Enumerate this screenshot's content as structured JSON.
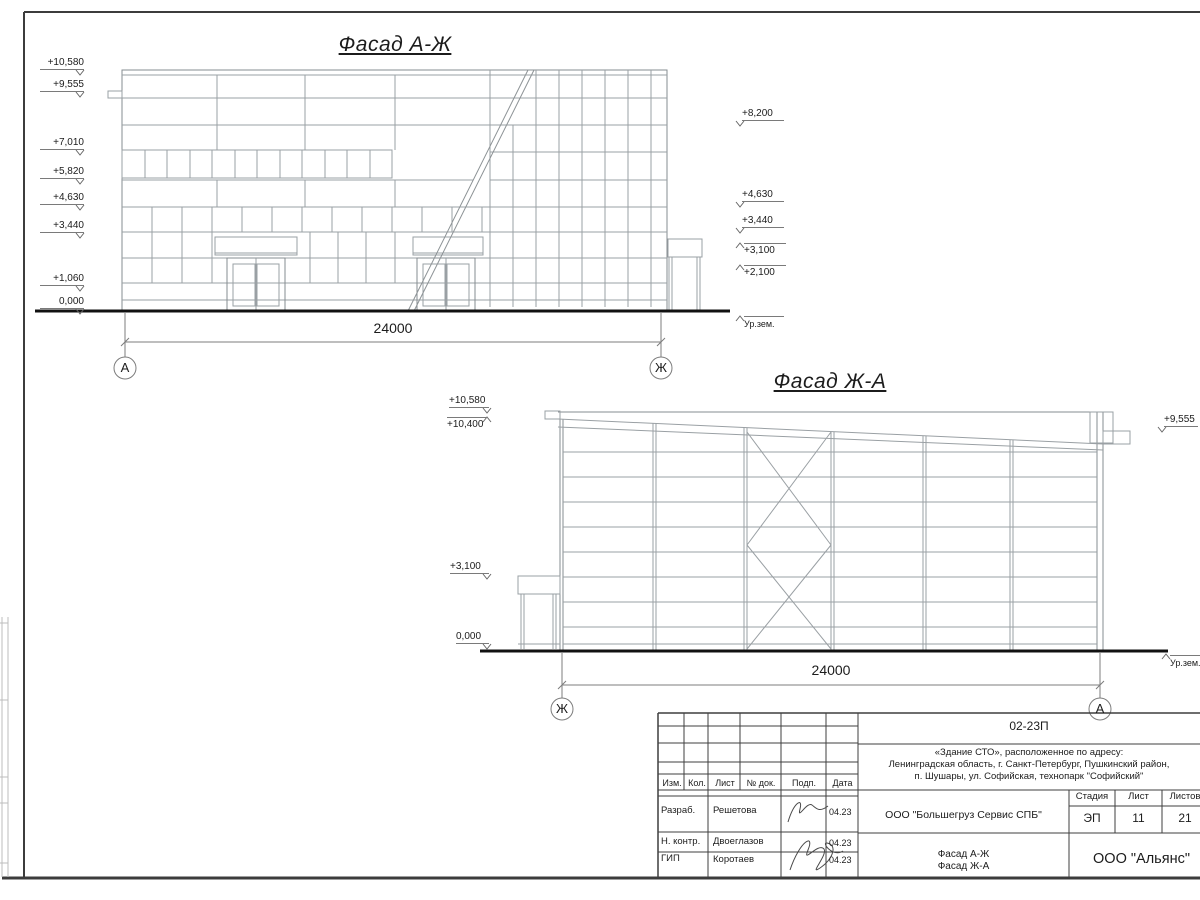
{
  "drawing": {
    "facade1": {
      "title": "Фасад А-Ж",
      "dim": "24000",
      "axis_left": "А",
      "axis_right": "Ж",
      "ground": "Ур.зем.",
      "marks_left": [
        "+10,580",
        "+9,555",
        "+7,010",
        "+5,820",
        "+4,630",
        "+3,440",
        "+1,060",
        "0,000"
      ],
      "marks_right": [
        "+8,200",
        "+4,630",
        "+3,440",
        "+3,100",
        "+2,100"
      ]
    },
    "facade2": {
      "title": "Фасад Ж-А",
      "dim": "24000",
      "axis_left": "Ж",
      "axis_right": "А",
      "ground": "Ур.зем.",
      "marks_left": [
        "+10,580",
        "+10,400",
        "+3,100",
        "0,000"
      ],
      "marks_right": [
        "+9,555"
      ]
    }
  },
  "titleblock": {
    "doc_code": "02-23П",
    "address_line1": "«Здание СТО», расположенное по адресу:",
    "address_line2": "Ленинградская область, г. Санкт-Петербург, Пушкинский район,",
    "address_line3": "п. Шушары, ул. Софийская, технопарк \"Софийский\"",
    "client": "ООО \"Большегруз Сервис СПБ\"",
    "stage_label": "Стадия",
    "sheet_label": "Лист",
    "sheets_label": "Листов",
    "stage": "ЭП",
    "sheet_no": "11",
    "sheets_total": "21",
    "content_line1": "Фасад А-Ж",
    "content_line2": "Фасад Ж-А",
    "organization": "ООО \"Альянс\"",
    "columns": {
      "izm": "Изм.",
      "kol": "Кол.",
      "list": "Лист",
      "doc": "№ док.",
      "podp": "Подп.",
      "data": "Дата"
    },
    "rows": [
      {
        "role": "Разраб.",
        "name": "Решетова",
        "date": "04.23"
      },
      {
        "role": "Н. контр.",
        "name": "Двоеглазов",
        "date": "04.23"
      },
      {
        "role": "ГИП",
        "name": "Коротаев",
        "date": "04.23"
      }
    ]
  }
}
